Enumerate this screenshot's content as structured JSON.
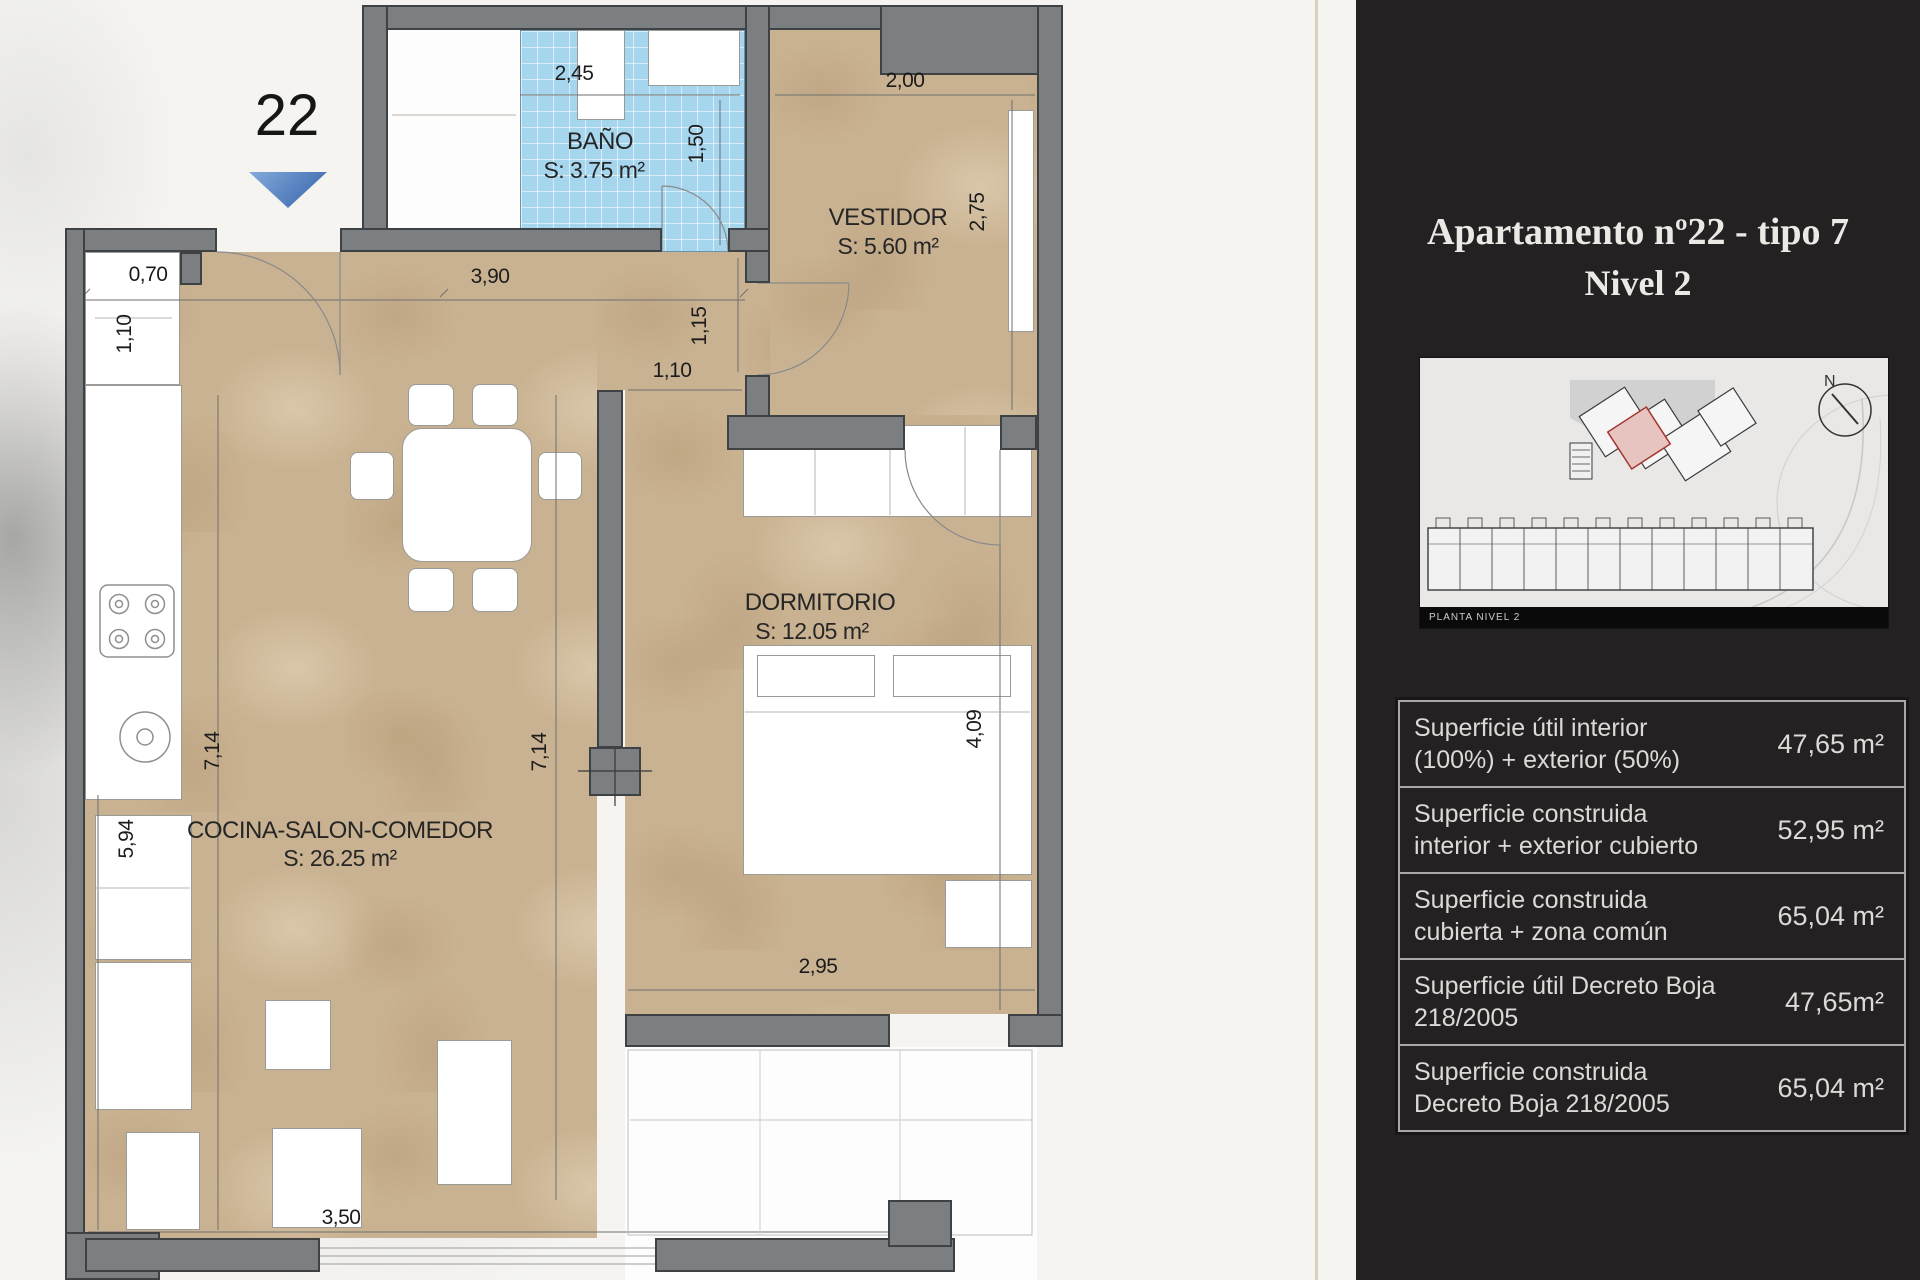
{
  "unit_marker": {
    "number": "22"
  },
  "floor_plan": {
    "rooms": {
      "bano": {
        "name": "BAÑO",
        "area": "S: 3.75 m²"
      },
      "vestidor": {
        "name": "VESTIDOR",
        "area": "S: 5.60 m²"
      },
      "dormitorio": {
        "name": "DORMITORIO",
        "area": "S: 12.05 m²"
      },
      "cocina_salon_comedor": {
        "name": "COCINA-SALON-COMEDOR",
        "area": "S: 26.25 m²"
      }
    },
    "dimensions": {
      "bano_width": "2,45",
      "bano_depth": "1,50",
      "vestidor_width": "2,00",
      "vestidor_depth": "2,75",
      "window_width": "0,70",
      "window_depth": "1,10",
      "hall_width": "3,90",
      "passage_depth": "1,15",
      "passage_width": "1,10",
      "salon_depth_left": "7,14",
      "salon_depth_right": "7,14",
      "salon_side": "5,94",
      "dormitorio_depth": "4,09",
      "dormitorio_width": "2,95",
      "salon_width": "3,50"
    }
  },
  "info_panel": {
    "title_line1": "Apartamento nº22 - tipo 7",
    "title_line2": "Nivel 2",
    "site_plan": {
      "caption": "PLANTA NIVEL 2",
      "compass": "N"
    },
    "area_table": {
      "rows": [
        {
          "line1": "Superficie útil interior",
          "line2": "(100%) + exterior (50%)",
          "value": "47,65 m²"
        },
        {
          "line1": "Superficie construida",
          "line2": "interior + exterior cubierto",
          "value": "52,95 m²"
        },
        {
          "line1": "Superficie construida",
          "line2": "cubierta + zona común",
          "value": "65,04 m²"
        },
        {
          "line1": "Superficie útil Decreto Boja",
          "line2": "218/2005",
          "value": "47,65m²"
        },
        {
          "line1": "Superficie construida",
          "line2": "Decreto Boja 218/2005",
          "value": "65,04 m²"
        }
      ]
    }
  },
  "colors": {
    "entry_arrow_blue": "#5b87c6",
    "bath_tile_blue": "#a6d6ee",
    "floor_beige": "#c9b291",
    "wall_gray": "#7b7f82",
    "panel_background": "#242122"
  }
}
